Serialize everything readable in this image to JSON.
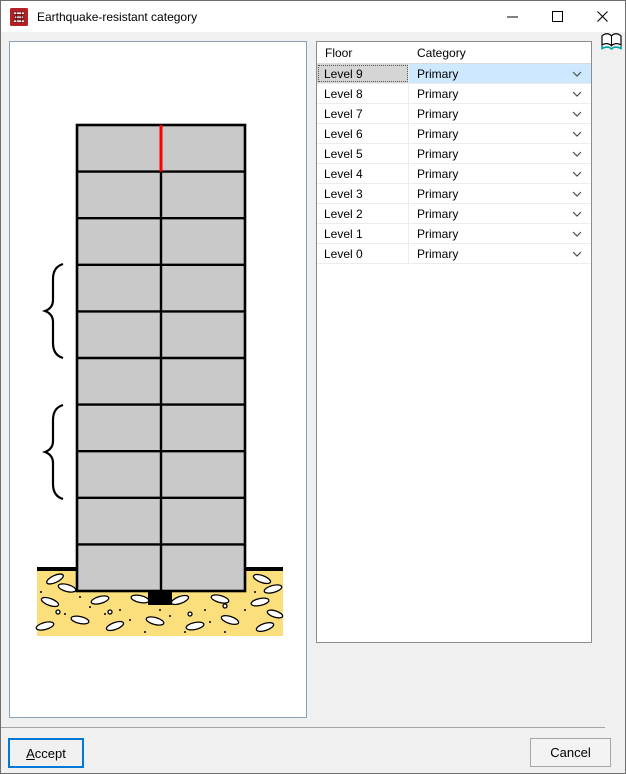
{
  "window": {
    "title": "Earthquake-resistant category"
  },
  "titlebar": {
    "icons": {
      "app": "building-structure-logo",
      "minimize": "thin-dash",
      "maximize": "outline-square",
      "close": "x-cross"
    }
  },
  "help": {
    "icon": "open-book"
  },
  "table": {
    "headers": [
      "Floor",
      "Category"
    ],
    "selected_floor": "Level 9",
    "rows": [
      {
        "floor": "Level 9",
        "category": "Primary",
        "selected": true
      },
      {
        "floor": "Level 8",
        "category": "Primary",
        "selected": false
      },
      {
        "floor": "Level 7",
        "category": "Primary",
        "selected": false
      },
      {
        "floor": "Level 6",
        "category": "Primary",
        "selected": false
      },
      {
        "floor": "Level 5",
        "category": "Primary",
        "selected": false
      },
      {
        "floor": "Level 4",
        "category": "Primary",
        "selected": false
      },
      {
        "floor": "Level 3",
        "category": "Primary",
        "selected": false
      },
      {
        "floor": "Level 2",
        "category": "Primary",
        "selected": false
      },
      {
        "floor": "Level 1",
        "category": "Primary",
        "selected": false
      },
      {
        "floor": "Level 0",
        "category": "Primary",
        "selected": false
      }
    ]
  },
  "diagram": {
    "floors": 10,
    "bays": 2,
    "building_fill": "#c9c9c9",
    "line_color": "#000000",
    "red_line_color": "#ff0000",
    "soil_fill": "#fcdf7d"
  },
  "footer": {
    "accept_label": "Accept",
    "accept_underlined": "A",
    "accept_rest": "ccept",
    "cancel_label": "Cancel"
  },
  "colors": {
    "accent_blue": "#0078d7",
    "selection_blue": "#cde8ff",
    "selection_gray": "#d5d5d5",
    "panel_border": "#8ba0b5"
  }
}
